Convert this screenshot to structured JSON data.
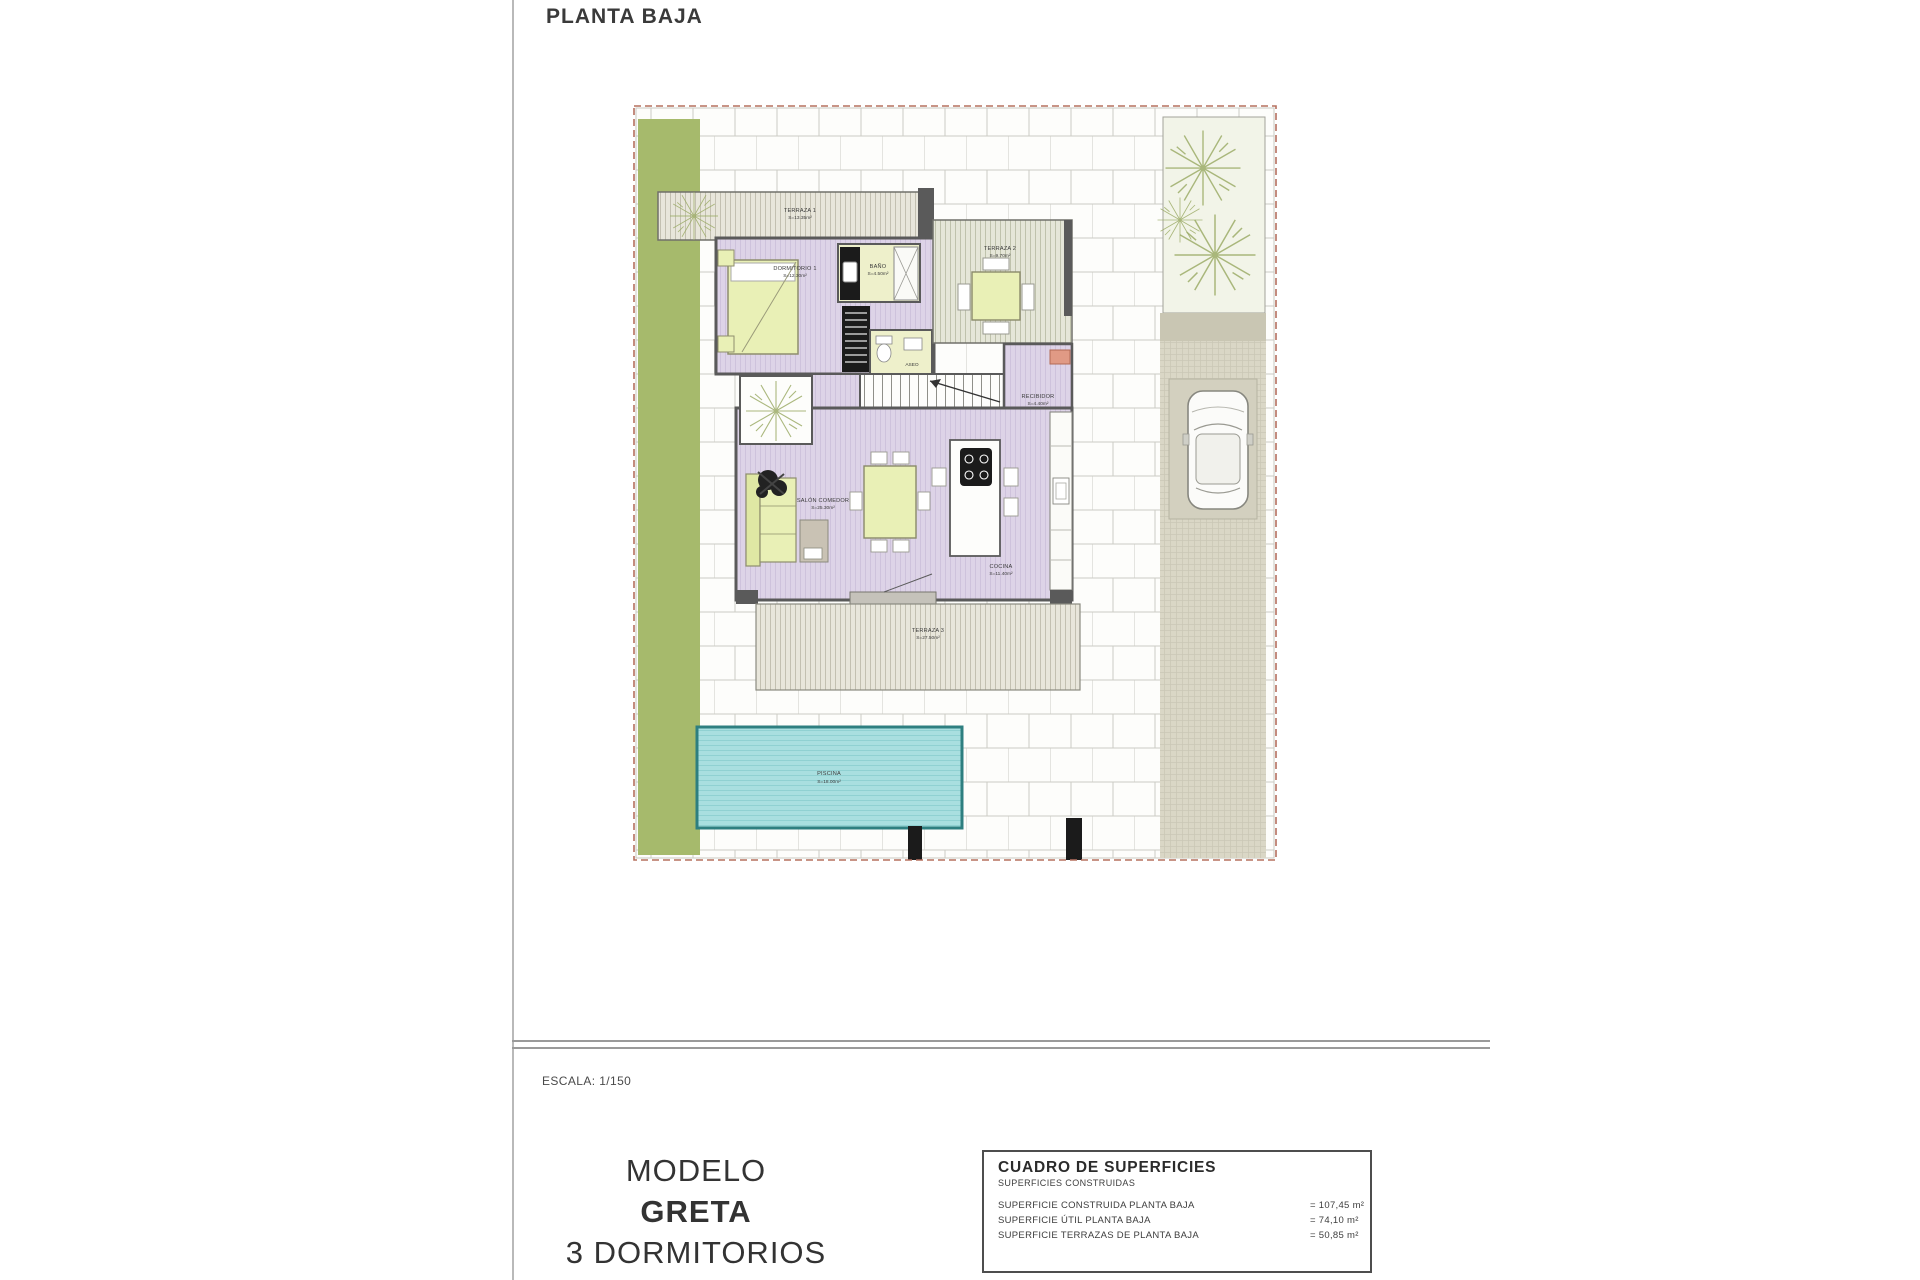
{
  "page": {
    "title": "PLANTA BAJA",
    "scale_label": "ESCALA: 1/150"
  },
  "model_block": {
    "line1": "MODELO",
    "line2": "GRETA",
    "line3": "3 DORMITORIOS"
  },
  "surfaces_table": {
    "title": "CUADRO DE SUPERFICIES",
    "subtitle": "SUPERFICIES CONSTRUIDAS",
    "rows": [
      {
        "label": "SUPERFICIE CONSTRUIDA PLANTA BAJA",
        "value": "= 107,45 m²"
      },
      {
        "label": "SUPERFICIE ÚTIL PLANTA BAJA",
        "value": "= 74,10 m²"
      },
      {
        "label": "SUPERFICIE TERRAZAS DE PLANTA BAJA",
        "value": "= 50,85 m²"
      }
    ]
  },
  "plan": {
    "rooms": {
      "terraza1": {
        "name": "TERRAZA 1",
        "area": "S=13.35m²"
      },
      "dormitorio1": {
        "name": "DORMITORIO 1",
        "area": "S=12.30m²"
      },
      "bano": {
        "name": "BAÑO",
        "area": "S=4.50m²"
      },
      "aseo": {
        "name": "ASEO",
        "area": "S=2.80m²"
      },
      "terraza2": {
        "name": "TERRAZA 2",
        "area": "S=9.70m²"
      },
      "recibidor": {
        "name": "RECIBIDOR",
        "area": "S=4.40m²"
      },
      "salon": {
        "name": "SALÓN COMEDOR",
        "area": "S=25.30m²"
      },
      "cocina": {
        "name": "COCINA",
        "area": "S=11.40m²"
      },
      "terraza3": {
        "name": "TERRAZA 3",
        "area": "S=27.50m²"
      },
      "piscina": {
        "name": "PISCINA",
        "area": "S=18.00m²"
      }
    },
    "colors": {
      "garden_green": "#a6ba6c",
      "interior_purple": "#ddd3e7",
      "terrace_gray": "#e8e6db",
      "furniture_yellow": "#e9f0b6",
      "bath_yellow": "#eef0cb",
      "pool_teal": "#a9dfe0",
      "pool_border": "#2e7f80",
      "wall_gray": "#5a5a5a",
      "boundary_dash": "#b5705f",
      "driveway_gray": "#dad7c6"
    }
  }
}
